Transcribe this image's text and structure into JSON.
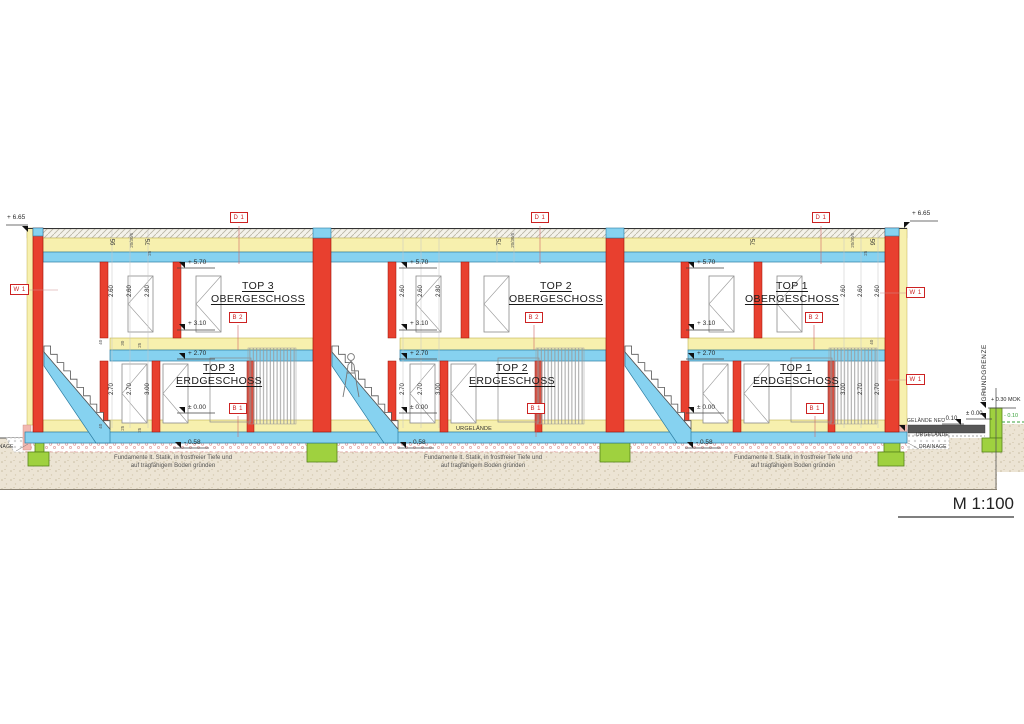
{
  "scale": {
    "label": "M 1:100"
  },
  "markers": {
    "d1": "D 1",
    "w1": "W 1",
    "b2": "B 2",
    "b1": "B 1"
  },
  "units": [
    {
      "name": "TOP 3",
      "upper": "OBERGESCHOSS",
      "lower": "ERDGESCHOSS"
    },
    {
      "name": "TOP 2",
      "upper": "OBERGESCHOSS",
      "lower": "ERDGESCHOSS"
    },
    {
      "name": "TOP 1",
      "upper": "OBERGESCHOSS",
      "lower": "ERDGESCHOSS"
    }
  ],
  "levels": {
    "roof": "+ 6.65",
    "og_ceiling": "+ 5.70",
    "og_floor": "+ 3.10",
    "eg_ceiling": "+ 2.70",
    "eg_floor": "± 0.00",
    "foundation": "- 0.58",
    "terrain_new": "- 0.10",
    "terrain_zero": "± 0.00",
    "wall_top": "+ 0.30 MOK",
    "urterrain": "- 0.10"
  },
  "dims": {
    "h260": "2.60",
    "h280": "2.80",
    "h270": "2.70",
    "h300": "3.00",
    "r95": "95",
    "r75": "75",
    "r40": "40",
    "r30": "30",
    "r25": "25",
    "layers": "20/30/5"
  },
  "site": {
    "urgelaende": "URGELÄNDE",
    "gelaende_neu": "GELÄNDE NEU",
    "grundgrenze": "GRUNDGRENZE",
    "drainage": "DRAINAGE"
  },
  "note": {
    "line1": "Fundamente lt. Statik, in frostfreier Tiefe und",
    "line2": "auf tragfähigem Boden gründen"
  },
  "colors": {
    "wall_red": "#e8402f",
    "slab_blue": "#86d2f0",
    "insulation_yellow": "#f7f0ae",
    "foundation_green": "#9fd13f",
    "marker_red": "#cc2222"
  }
}
